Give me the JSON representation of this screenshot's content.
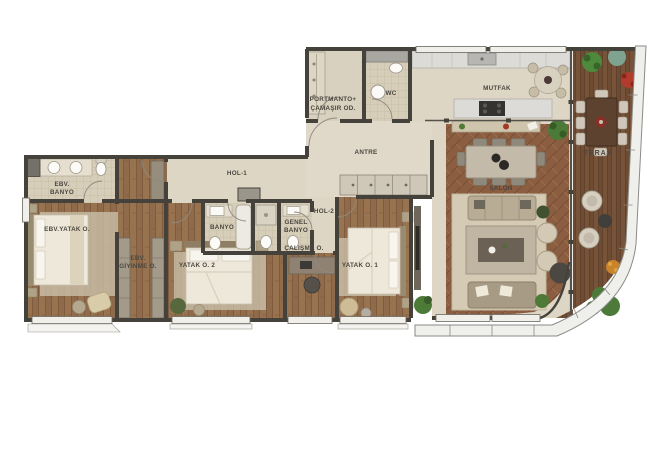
{
  "plan": {
    "kind": "apartment-floor-plan",
    "labels": {
      "ebv_banyo_1": "EBV.",
      "ebv_banyo_2": "BANYO",
      "ebv_yatak": "EBV.YATAK O.",
      "ebv_giyinme_1": "EBV.",
      "ebv_giyinme_2": "GİYİNME O.",
      "hol1": "HOL-1",
      "hol2": "HOL-2",
      "banyo": "BANYO",
      "genel_banyo_1": "GENEL",
      "genel_banyo_2": "BANYO",
      "yatak2": "YATAK O. 2",
      "calisma": "ÇALIŞMA O.",
      "yatak1": "YATAK O. 1",
      "antre": "ANTRE",
      "portmanto_1": "PORTMANTO+",
      "portmanto_2": "ÇAMAŞIR OD.",
      "wc": "WC",
      "mutfak": "MUTFAK",
      "salon": "SALON",
      "teras": "TERAS"
    },
    "colors": {
      "wall": "#45423c",
      "floor_beige": "#ded6c5",
      "floor_tile": "#d7ceba",
      "wood_room": "#8f6b4c",
      "wood_salon": "#8b5e41",
      "wood_deck": "#6e4b33",
      "rug": "#cfc4ae",
      "plant_green": "#4c7a38",
      "accent_red": "#b23b2e"
    }
  }
}
